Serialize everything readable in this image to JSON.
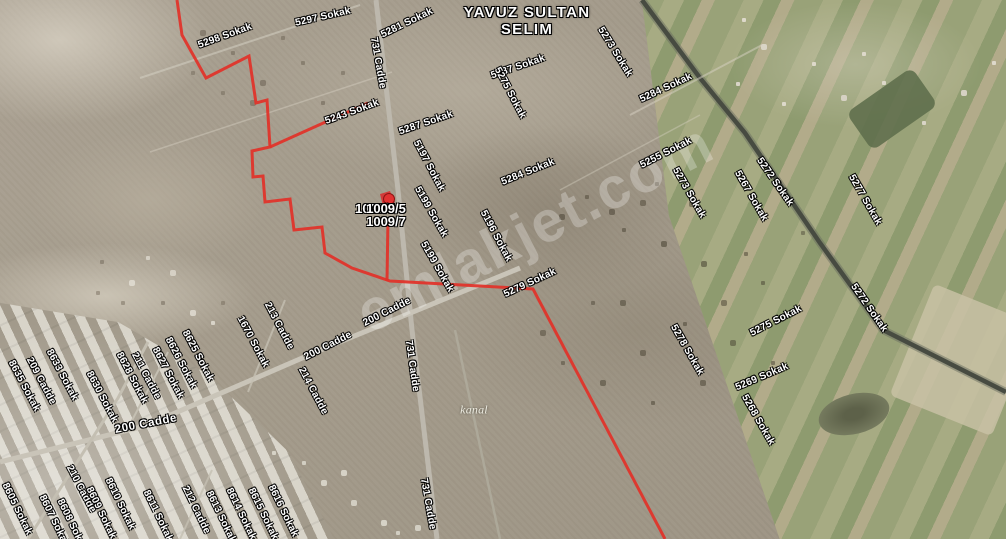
{
  "map": {
    "area_title": {
      "line1": "YAVUZ SULTAN",
      "line2": "SELIM"
    },
    "watermark": "emlakjet.com",
    "parcel": {
      "line1": "1009/5",
      "line2": "1009/7",
      "ghost": "1009/5"
    },
    "colors": {
      "boundary": "#e23128",
      "marker": "#d63031",
      "label_text": "#ffffff"
    },
    "boundary": {
      "paths": [
        [
          [
            177,
            0
          ],
          [
            182,
            35
          ],
          [
            206,
            78
          ],
          [
            249,
            56
          ],
          [
            256,
            103
          ],
          [
            267,
            100
          ],
          [
            270,
            147
          ],
          [
            252,
            151
          ],
          [
            253,
            177
          ],
          [
            263,
            176
          ],
          [
            265,
            202
          ],
          [
            290,
            199
          ],
          [
            294,
            230
          ],
          [
            322,
            227
          ],
          [
            325,
            253
          ],
          [
            352,
            268
          ],
          [
            390,
            281
          ],
          [
            533,
            289
          ],
          [
            665,
            539
          ]
        ],
        [
          [
            270,
            147
          ],
          [
            330,
            120
          ],
          [
            368,
            103
          ]
        ],
        [
          [
            388,
            218
          ],
          [
            387,
            281
          ]
        ]
      ]
    },
    "labels": [
      {
        "text": "5298 Sokak",
        "x": 225,
        "y": 36,
        "r": -20
      },
      {
        "text": "5297 Sokak",
        "x": 323,
        "y": 17,
        "r": -13
      },
      {
        "text": "5281 Sokak",
        "x": 407,
        "y": 23,
        "r": -26
      },
      {
        "text": "731 Cadde",
        "x": 378,
        "y": 63,
        "r": 80
      },
      {
        "text": "5273 Sokak",
        "x": 615,
        "y": 52,
        "r": 58
      },
      {
        "text": "5284 Sokak",
        "x": 666,
        "y": 88,
        "r": -25
      },
      {
        "text": "5243 Sokak",
        "x": 352,
        "y": 112,
        "r": -20
      },
      {
        "text": "5287 Sokak",
        "x": 518,
        "y": 67,
        "r": -19
      },
      {
        "text": "5275 Sokak",
        "x": 510,
        "y": 93,
        "r": 62
      },
      {
        "text": "5287 Sokak",
        "x": 426,
        "y": 123,
        "r": -19
      },
      {
        "text": "5197 Sokak",
        "x": 429,
        "y": 166,
        "r": 62
      },
      {
        "text": "5284 Sokak",
        "x": 528,
        "y": 172,
        "r": -22
      },
      {
        "text": "5199 Sokak",
        "x": 431,
        "y": 212,
        "r": 60
      },
      {
        "text": "5199 Sokak",
        "x": 437,
        "y": 267,
        "r": 60
      },
      {
        "text": "5196 Sokak",
        "x": 496,
        "y": 236,
        "r": 62
      },
      {
        "text": "5255 Sokak",
        "x": 666,
        "y": 153,
        "r": -27
      },
      {
        "text": "5273 Sokak",
        "x": 689,
        "y": 193,
        "r": 60
      },
      {
        "text": "5267 Sokak",
        "x": 751,
        "y": 196,
        "r": 60
      },
      {
        "text": "5272 Sokak",
        "x": 775,
        "y": 182,
        "r": 55
      },
      {
        "text": "5277 Sokak",
        "x": 865,
        "y": 200,
        "r": 60
      },
      {
        "text": "5272 Sokak",
        "x": 869,
        "y": 308,
        "r": 55
      },
      {
        "text": "5275 Sokak",
        "x": 776,
        "y": 321,
        "r": -27
      },
      {
        "text": "5278 Sokak",
        "x": 687,
        "y": 350,
        "r": 60
      },
      {
        "text": "5269 Sokak",
        "x": 762,
        "y": 377,
        "r": -23
      },
      {
        "text": "5268 Sokak",
        "x": 758,
        "y": 420,
        "r": 60
      },
      {
        "text": "5279 Sokak",
        "x": 530,
        "y": 283,
        "r": -25
      },
      {
        "text": "731 Cadde",
        "x": 412,
        "y": 366,
        "r": 82
      },
      {
        "text": "731 Cadde",
        "x": 428,
        "y": 504,
        "r": 80
      },
      {
        "text": "213 Cadde",
        "x": 279,
        "y": 326,
        "r": 62
      },
      {
        "text": "1670 Sokak",
        "x": 253,
        "y": 342,
        "r": 62
      },
      {
        "text": "200 Cadde",
        "x": 328,
        "y": 346,
        "r": -27
      },
      {
        "text": "200 Cadde",
        "x": 387,
        "y": 312,
        "r": -27
      },
      {
        "text": "214 Cadde",
        "x": 313,
        "y": 391,
        "r": 62
      },
      {
        "text": "200 Cadde",
        "x": 146,
        "y": 424,
        "r": -11,
        "kind": "major"
      },
      {
        "text": "210 Cadde",
        "x": 81,
        "y": 489,
        "r": 62
      },
      {
        "text": "209 Cadde",
        "x": 41,
        "y": 381,
        "r": 62
      },
      {
        "text": "211 Cadde",
        "x": 146,
        "y": 376,
        "r": 62
      },
      {
        "text": "8635 Sokak",
        "x": 24,
        "y": 386,
        "r": 62
      },
      {
        "text": "8633 Sokak",
        "x": 62,
        "y": 375,
        "r": 62
      },
      {
        "text": "8630 Sokak",
        "x": 102,
        "y": 397,
        "r": 62
      },
      {
        "text": "8628 Sokak",
        "x": 132,
        "y": 378,
        "r": 62
      },
      {
        "text": "8627 Sokak",
        "x": 168,
        "y": 373,
        "r": 62
      },
      {
        "text": "8626 Sokak",
        "x": 181,
        "y": 363,
        "r": 62
      },
      {
        "text": "8625 Sokak",
        "x": 198,
        "y": 356,
        "r": 62
      },
      {
        "text": "8605 Sokak",
        "x": 17,
        "y": 509,
        "r": 64
      },
      {
        "text": "8607 Sokak",
        "x": 54,
        "y": 521,
        "r": 64
      },
      {
        "text": "8608 Sokak",
        "x": 72,
        "y": 525,
        "r": 64
      },
      {
        "text": "8609 Sokak",
        "x": 101,
        "y": 513,
        "r": 64
      },
      {
        "text": "8610 Sokak",
        "x": 120,
        "y": 504,
        "r": 64
      },
      {
        "text": "8611 Sokak",
        "x": 158,
        "y": 516,
        "r": 64
      },
      {
        "text": "212 Cadde",
        "x": 196,
        "y": 510,
        "r": 64
      },
      {
        "text": "8613 Sokak",
        "x": 221,
        "y": 517,
        "r": 64
      },
      {
        "text": "8614 Sokak",
        "x": 241,
        "y": 514,
        "r": 64
      },
      {
        "text": "8615 Sokak",
        "x": 263,
        "y": 514,
        "r": 64
      },
      {
        "text": "8616 Sokak",
        "x": 283,
        "y": 511,
        "r": 64
      },
      {
        "text": "kanal",
        "x": 474,
        "y": 410,
        "r": 0,
        "kind": "water"
      }
    ]
  }
}
